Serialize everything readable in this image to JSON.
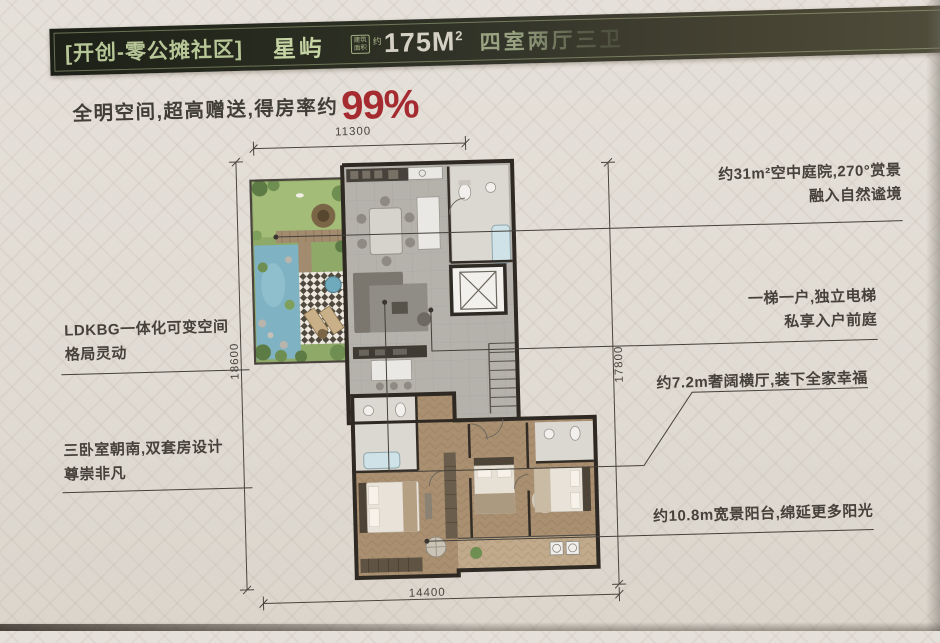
{
  "header": {
    "community_tag": "[开创-零公摊社区]",
    "product_name": "星屿",
    "badge": {
      "line1": "建筑",
      "line2": "面积"
    },
    "area_prefix": "约",
    "area_value": "175M",
    "area_exponent": "2",
    "layout_spec": "四室两厅三卫"
  },
  "tagline": {
    "text": "全明空间,超高赠送,得房率约",
    "highlight": "99%"
  },
  "annotations": {
    "left": [
      {
        "line1": "LDKBG一体化可变空间",
        "line2": "格局灵动"
      },
      {
        "line1": "三卧室朝南,双套房设计",
        "line2": "尊崇非凡"
      }
    ],
    "right": [
      {
        "line1": "约31m²空中庭院,270°赏景",
        "line2": "融入自然谧境"
      },
      {
        "line1": "一梯一户,独立电梯",
        "line2": "私享入户前庭"
      },
      {
        "line1": "约7.2m奢阔横厅,装下全家幸福"
      },
      {
        "line1": "约10.8m宽景阳台,绵延更多阳光"
      }
    ]
  },
  "dimensions": {
    "top": "11300",
    "left": "18600",
    "right": "17800",
    "bottom": "14400"
  },
  "palette": {
    "band_background": "#2a2d20",
    "band_text_green": "#b7c697",
    "accent_red": "#a62b30",
    "wall_dark": "#2e2922",
    "floor_gray": "#b5b2ac",
    "floor_wood": "#aa9071",
    "garden_green": "#9db472",
    "water_blue": "#7fb2c2",
    "page_background": "#e1dcd4"
  }
}
